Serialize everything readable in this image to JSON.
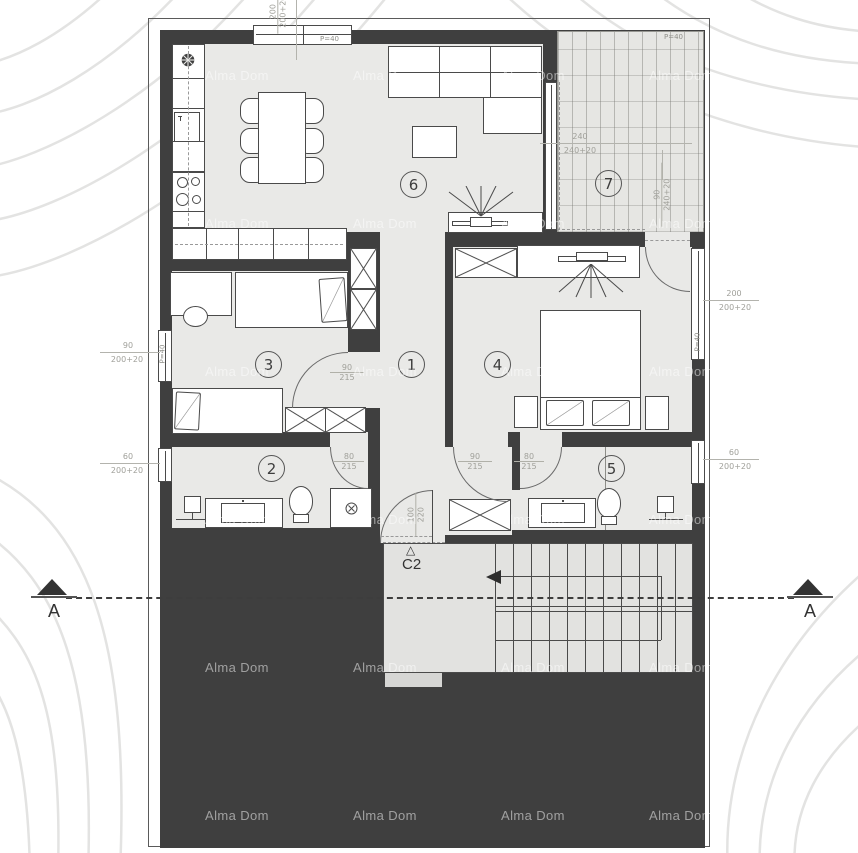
{
  "watermark": {
    "text": "Alma Dom"
  },
  "colors": {
    "wall": "#3f3f3f",
    "floor": "#e9e9e7",
    "terrace": "#e6e6e3",
    "paper": "#ffffff",
    "dim_text": "#a0a09a"
  },
  "rooms": [
    {
      "number": "1"
    },
    {
      "number": "2"
    },
    {
      "number": "3"
    },
    {
      "number": "4"
    },
    {
      "number": "5"
    },
    {
      "number": "6"
    },
    {
      "number": "7"
    }
  ],
  "section": {
    "left": "A",
    "right": "A"
  },
  "stairs": {
    "mark": "C2",
    "mark_symbol": "△"
  },
  "labels": {
    "p40": "P=40",
    "top_win": {
      "a": "200",
      "b": "200+20"
    },
    "terrace_w": {
      "a": "240",
      "b": "240+20"
    },
    "terrace_d": {
      "a": "90",
      "b": "240+20"
    },
    "left_w1": {
      "a": "90",
      "b": "200+20"
    },
    "left_w2": {
      "a": "60",
      "b": "200+20"
    },
    "right_w1": {
      "a": "200",
      "b": "200+20"
    },
    "right_w2": {
      "a": "60",
      "b": "200+20"
    },
    "door_r3": {
      "a": "90",
      "b": "215"
    },
    "door_r2": {
      "a": "80",
      "b": "215"
    },
    "door_r4": {
      "a": "90",
      "b": "215"
    },
    "door_r5": {
      "a": "80",
      "b": "215"
    },
    "door_entry": {
      "a": "100",
      "b": "220"
    }
  }
}
